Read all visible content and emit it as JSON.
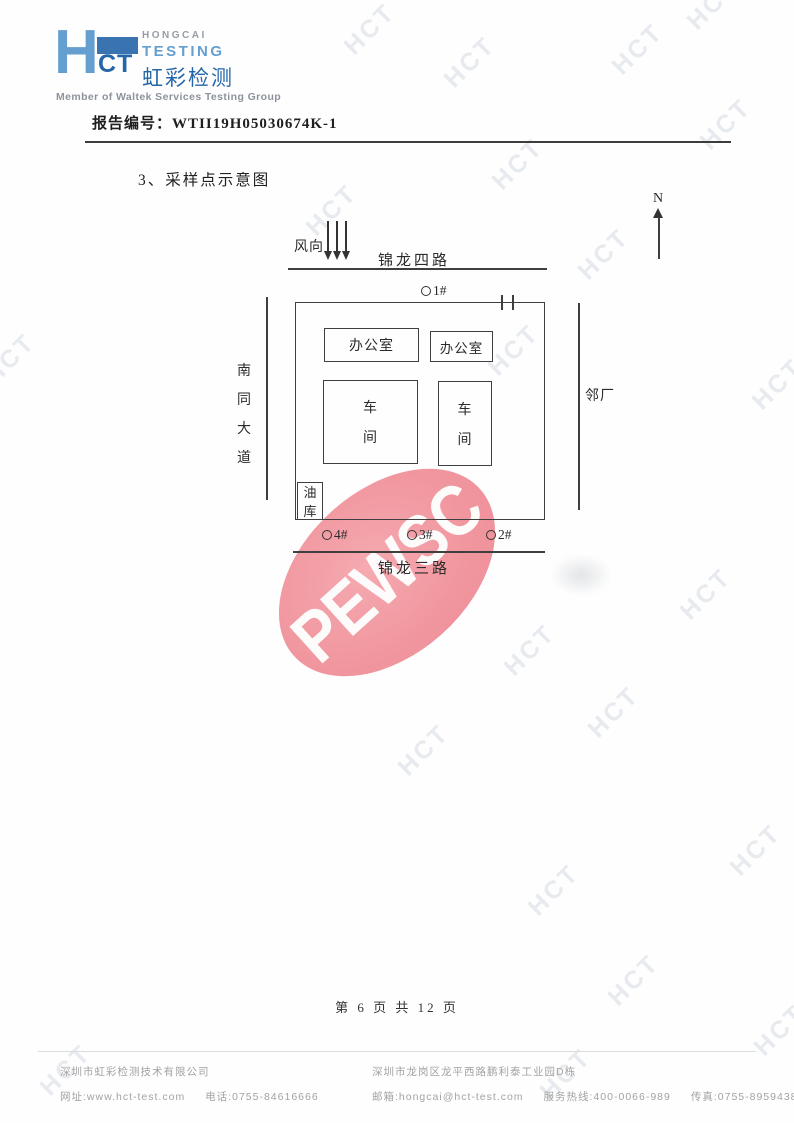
{
  "colors": {
    "brand_blue": "#2566a9",
    "brand_mid_blue": "#3a74b0",
    "brand_light_blue": "#649fd0",
    "stamp_pink": "#f08f98",
    "watermark_gray": "#e7eaee"
  },
  "watermark": {
    "text": "HCT"
  },
  "header": {
    "logo": {
      "h": "H",
      "ct": "CT",
      "en1": "HONGCAI",
      "en2": "TESTING",
      "cn": "虹彩检测",
      "member": "Member of Waltek Services Testing Group"
    },
    "report_label": "报告编号：",
    "report_number": "WTII19H05030674K-1"
  },
  "section_title": "3、采样点示意图",
  "diagram": {
    "north": "N",
    "wind": "风向",
    "road_top": "锦龙四路",
    "road_bottom": "锦龙三路",
    "road_left": [
      "南",
      "同",
      "大",
      "道"
    ],
    "neighbor": "邻厂",
    "offices": [
      "办公室",
      "办公室"
    ],
    "workshop": [
      "车",
      "间"
    ],
    "oil_depot": [
      "油",
      "库"
    ],
    "points": {
      "p1": "1#",
      "p2": "2#",
      "p3": "3#",
      "p4": "4#"
    }
  },
  "stamp": {
    "text": "PEWSC"
  },
  "footer": {
    "page_info": "第 6 页 共 12 页",
    "company": "深圳市虹彩检测技术有限公司",
    "website": "网址:www.hct-test.com",
    "phone": "电话:0755-84616666",
    "address": "深圳市龙岗区龙平西路鹏利泰工业园D栋",
    "email": "邮箱:hongcai@hct-test.com",
    "hotline": "服务热线:400-0066-989",
    "fax": "传真:0755-89594380"
  }
}
